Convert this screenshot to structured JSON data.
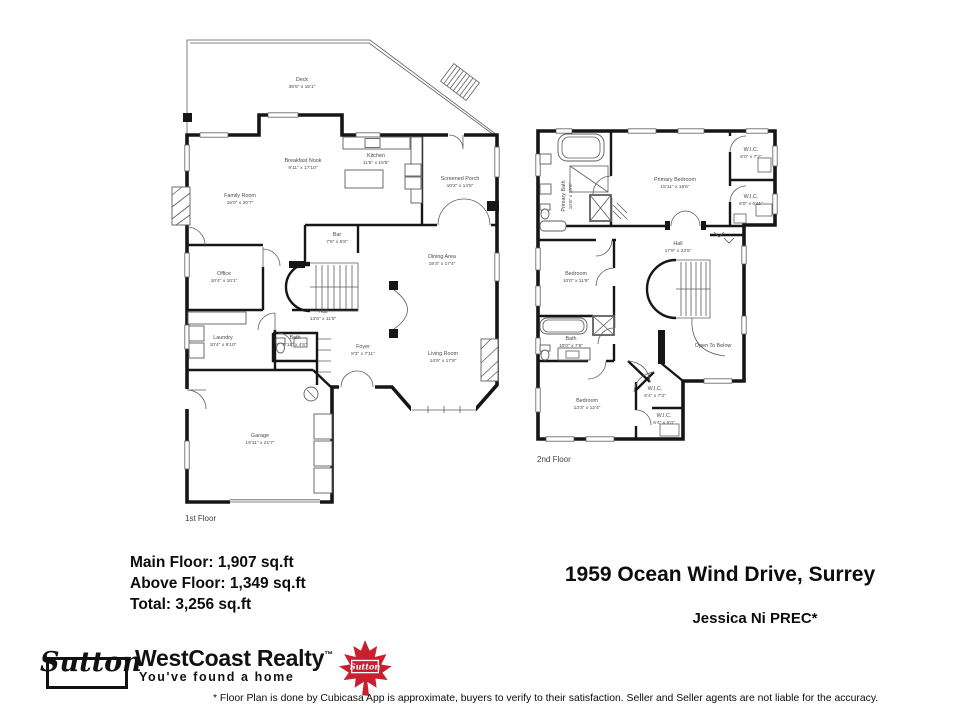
{
  "floor1": {
    "caption": "1st Floor",
    "rooms": [
      {
        "name": "Deck",
        "dims": "39'5\" x 15'1\""
      },
      {
        "name": "Breakfast Nook",
        "dims": "9'11\" x 17'10\""
      },
      {
        "name": "Kitchen",
        "dims": "11'5\" x 15'5\""
      },
      {
        "name": "Screened Porch",
        "dims": "10'2\" x 14'5\""
      },
      {
        "name": "Family Room",
        "dims": "16'0\" x 20'7\""
      },
      {
        "name": "Bar",
        "dims": "7'5\" x 5'8\""
      },
      {
        "name": "Dining Area",
        "dims": "19'3\" x 17'4\""
      },
      {
        "name": "Office",
        "dims": "10'4\" x 10'1\""
      },
      {
        "name": "Hall",
        "dims": "13'6\" x 11'5\""
      },
      {
        "name": "Laundry",
        "dims": "10'4\" x 9'10\""
      },
      {
        "name": "Bath",
        "dims": "5'11\" x 4'6\""
      },
      {
        "name": "Foyer",
        "dims": "8'3\" x 7'11\""
      },
      {
        "name": "Living Room",
        "dims": "14'9\" x 17'8\""
      },
      {
        "name": "Garage",
        "dims": "19'11\" x 21'7\""
      }
    ]
  },
  "floor2": {
    "caption": "2nd Floor",
    "rooms": [
      {
        "name": "Primary Bath",
        "dims": "10'8\" x 15'6\""
      },
      {
        "name": "Primary Bedroom",
        "dims": "15'11\" x 16'6\""
      },
      {
        "name": "W.I.C.",
        "dims": "6'0\" x 7'2\""
      },
      {
        "name": "W.I.C.",
        "dims": "6'0\" x 6'11\""
      },
      {
        "name": "Hall",
        "dims": "17'9\" x 23'5\""
      },
      {
        "name": "Bedroom",
        "dims": "10'0\" x 11'9\""
      },
      {
        "name": "Bath",
        "dims": "10'0\" x 7'6\""
      },
      {
        "name": "Open To Below",
        "dims": ""
      },
      {
        "name": "Bedroom",
        "dims": "13'3\" x 12'4\""
      },
      {
        "name": "W.I.C.",
        "dims": "6'4\" x 7'3\""
      },
      {
        "name": "W.I.C.",
        "dims": "6'4\" x 5'0\""
      }
    ]
  },
  "stats": {
    "main": "Main Floor: 1,907 sq.ft",
    "above": "Above Floor: 1,349 sq.ft",
    "total": "Total: 3,256 sq.ft"
  },
  "listing": {
    "address": "1959 Ocean Wind Drive, Surrey",
    "agent": "Jessica Ni PREC*"
  },
  "brand": {
    "wordmark": "Sutton",
    "company": "WestCoast Realty",
    "tm": "™",
    "tagline": "You've found a home",
    "leaf_label": "Sutton",
    "leaf_color": "#c8202e"
  },
  "disclaimer": "* Floor Plan is done by Cubicasa App is approximate, buyers to verify to their satisfaction.  Seller and Seller agents are not liable for the accuracy."
}
